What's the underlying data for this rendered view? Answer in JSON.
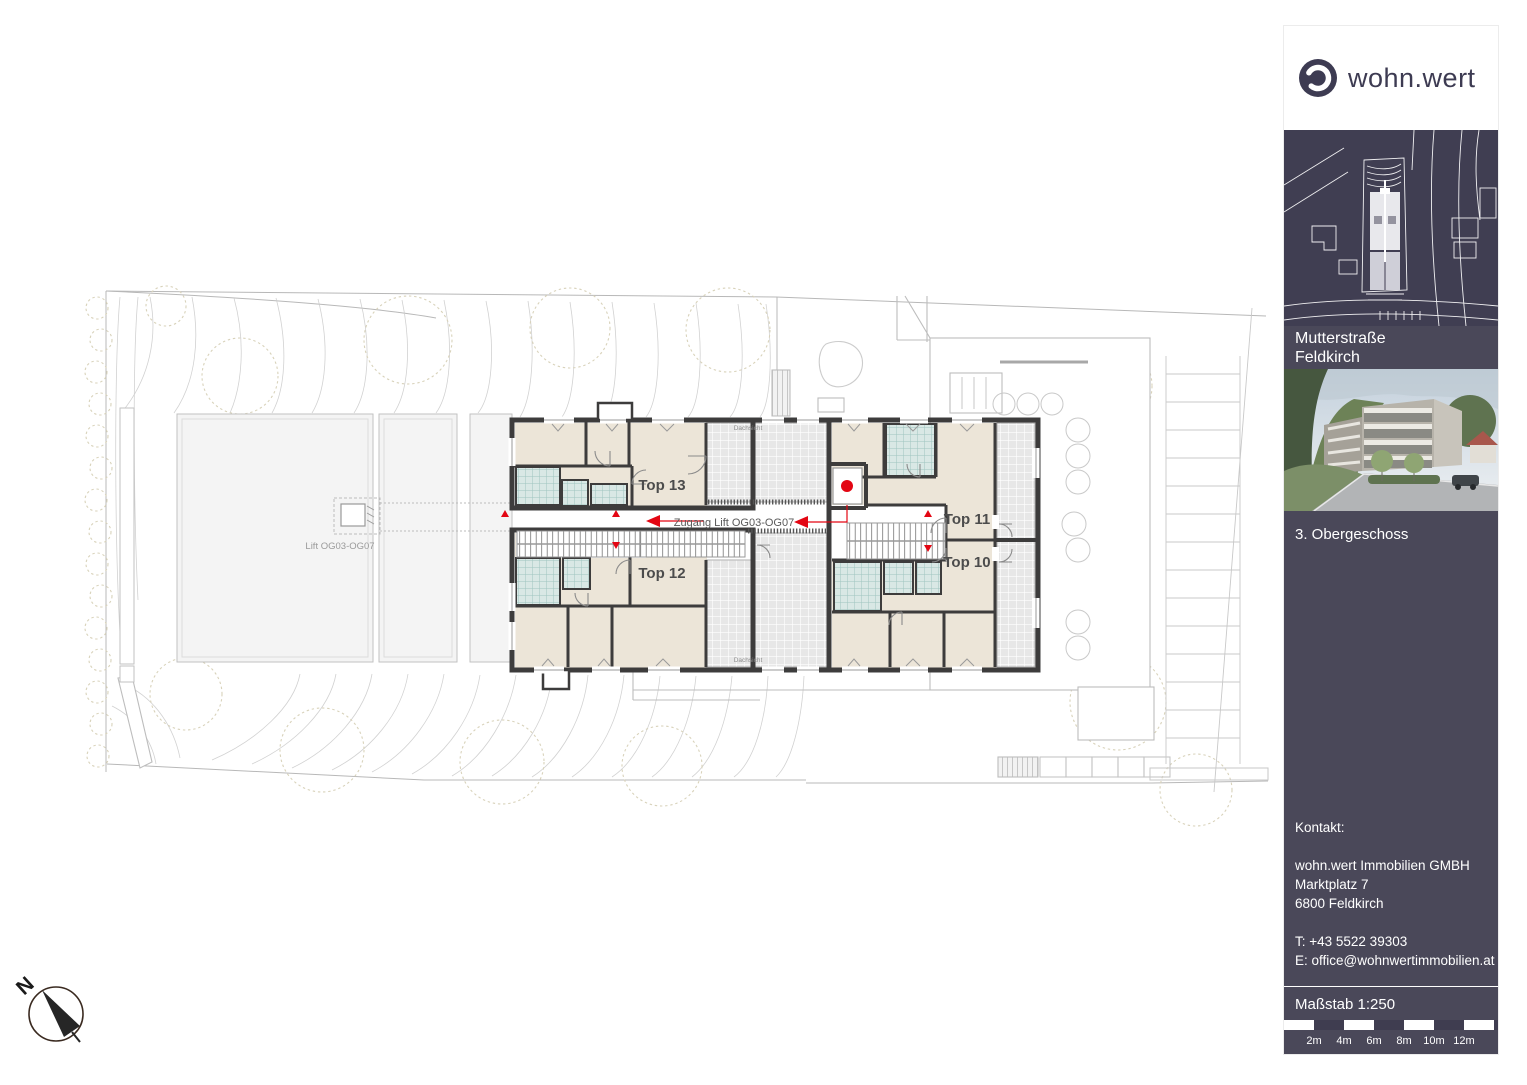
{
  "plan": {
    "units": [
      {
        "label": "Top 13"
      },
      {
        "label": "Top 12"
      },
      {
        "label": "Top 11"
      },
      {
        "label": "Top 10"
      }
    ],
    "corridor_label": "Zugang Lift OG03-OG07",
    "lift_label": "Lift OG03-OG07",
    "terrace_label": "Dachsicht",
    "compass_n": "N",
    "colors": {
      "wall": "#3d3c3c",
      "room": "#ece5d8",
      "wet_room": "#d9e8e5",
      "terrace": "#e7e7e7",
      "accent_red": "#e30613"
    }
  },
  "sidebar": {
    "logo_text": "wohn.wert",
    "project": {
      "line1": "Mutterstraße",
      "line2": "Feldkirch"
    },
    "floor_label": "3. Obergeschoss",
    "contact": {
      "heading": "Kontakt:",
      "company": "wohn.wert Immobilien GMBH",
      "street": "Marktplatz 7",
      "city": "6800 Feldkirch",
      "phone": "T: +43 5522 39303",
      "email": "E: office@wohnwertimmobilien.at"
    },
    "scale": {
      "label": "Maßstab 1:250",
      "ticks": [
        "2m",
        "4m",
        "6m",
        "8m",
        "10m",
        "12m"
      ]
    },
    "colors": {
      "panel": "#4a4859",
      "map_bg": "#403e52",
      "logo_navy": "#3d3b52"
    }
  }
}
